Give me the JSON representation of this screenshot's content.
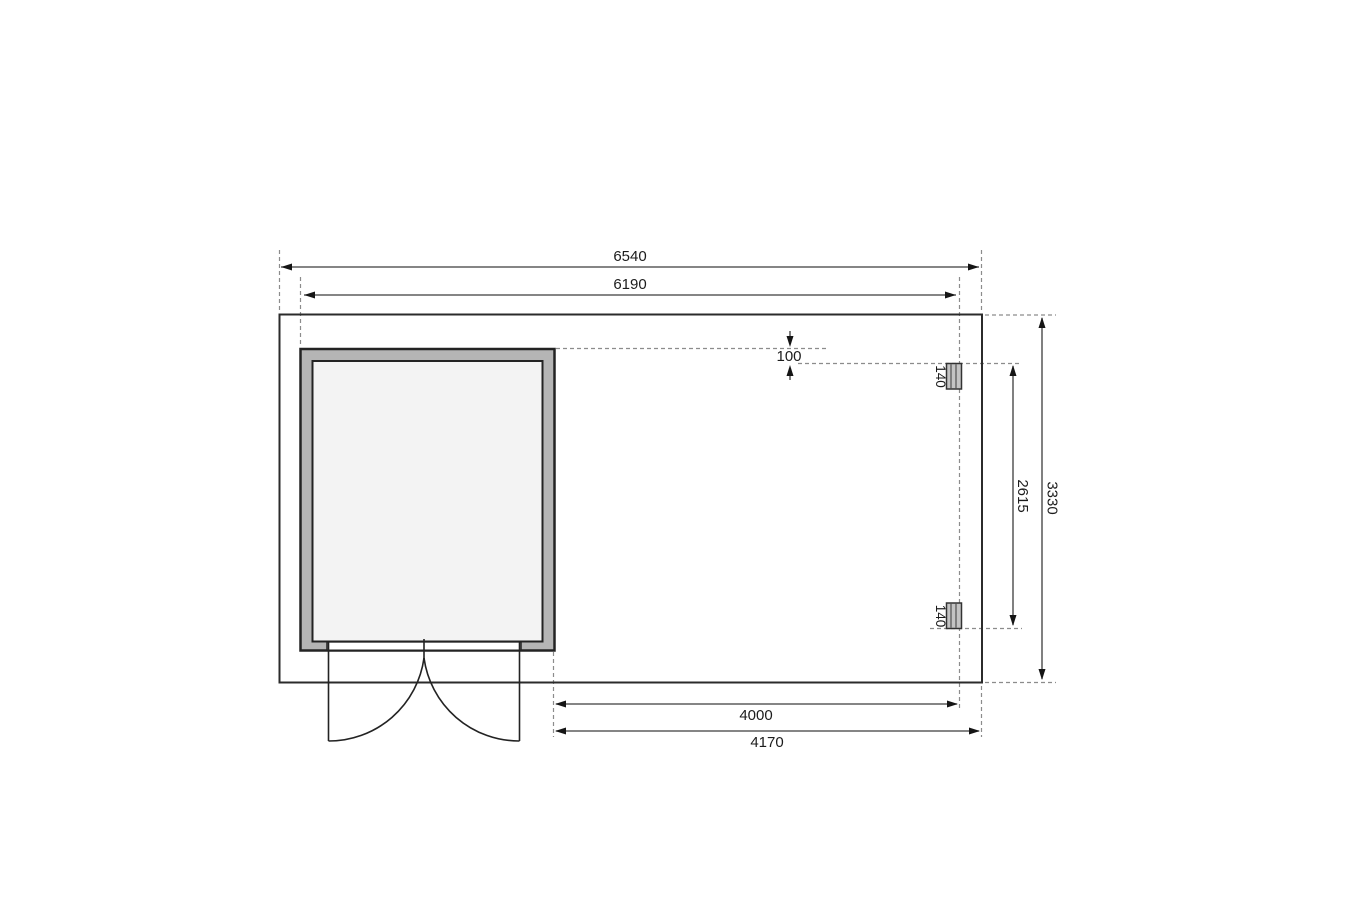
{
  "labels": {
    "dim_top_outer": "6540",
    "dim_top_inner": "6190",
    "dim_right_outer": "3330",
    "dim_right_inner": "2615",
    "dim_offset": "100",
    "post_upper": "140",
    "post_lower": "140",
    "dim_bottom_inner": "4000",
    "dim_bottom_outer": "4170"
  },
  "colors": {
    "background": "#ffffff",
    "platform_fill": "#f4f4f4",
    "wall_fill": "#b5b5b5",
    "interior_fill": "#f3f3f3",
    "opening_fill": "#ffffff",
    "post_fill": "#c4c4c4",
    "outline": "#2b2b2b",
    "dimension_line": "#3c3c3c",
    "guide_dash": "#8c8c8c",
    "text": "#1c1c1c"
  }
}
